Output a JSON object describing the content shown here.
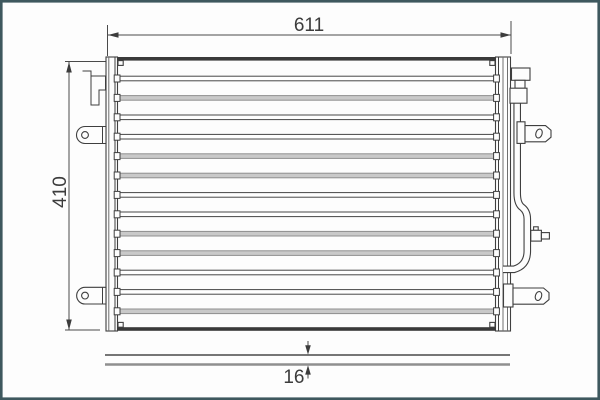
{
  "drawing": {
    "subject": "air-conditioning-condenser-front-view",
    "dim_width": {
      "label": "611"
    },
    "dim_height": {
      "label": "410"
    },
    "dim_depth": {
      "label": "16"
    },
    "core": {
      "tube_count": 13,
      "tube_first_center_y": 78.5,
      "tube_spacing": 19.4,
      "tube_height": 4.6,
      "left_x": 117.5,
      "right_x": 495.5,
      "top_y": 57,
      "bottom_y": 331,
      "tube_styles": [
        "dark",
        "gray",
        "dark",
        "dark",
        "gray",
        "gray",
        "dark",
        "dark",
        "gray",
        "gray",
        "dark",
        "dark",
        "gray"
      ]
    },
    "colors": {
      "frame_border": "#3e585e",
      "line": "#3f3f3f",
      "tube_gray_fill": "#c9c9c9",
      "tube_gray_stroke": "#8f8f8f",
      "background": "#fdfdfd",
      "text": "#3c3c3c"
    }
  }
}
